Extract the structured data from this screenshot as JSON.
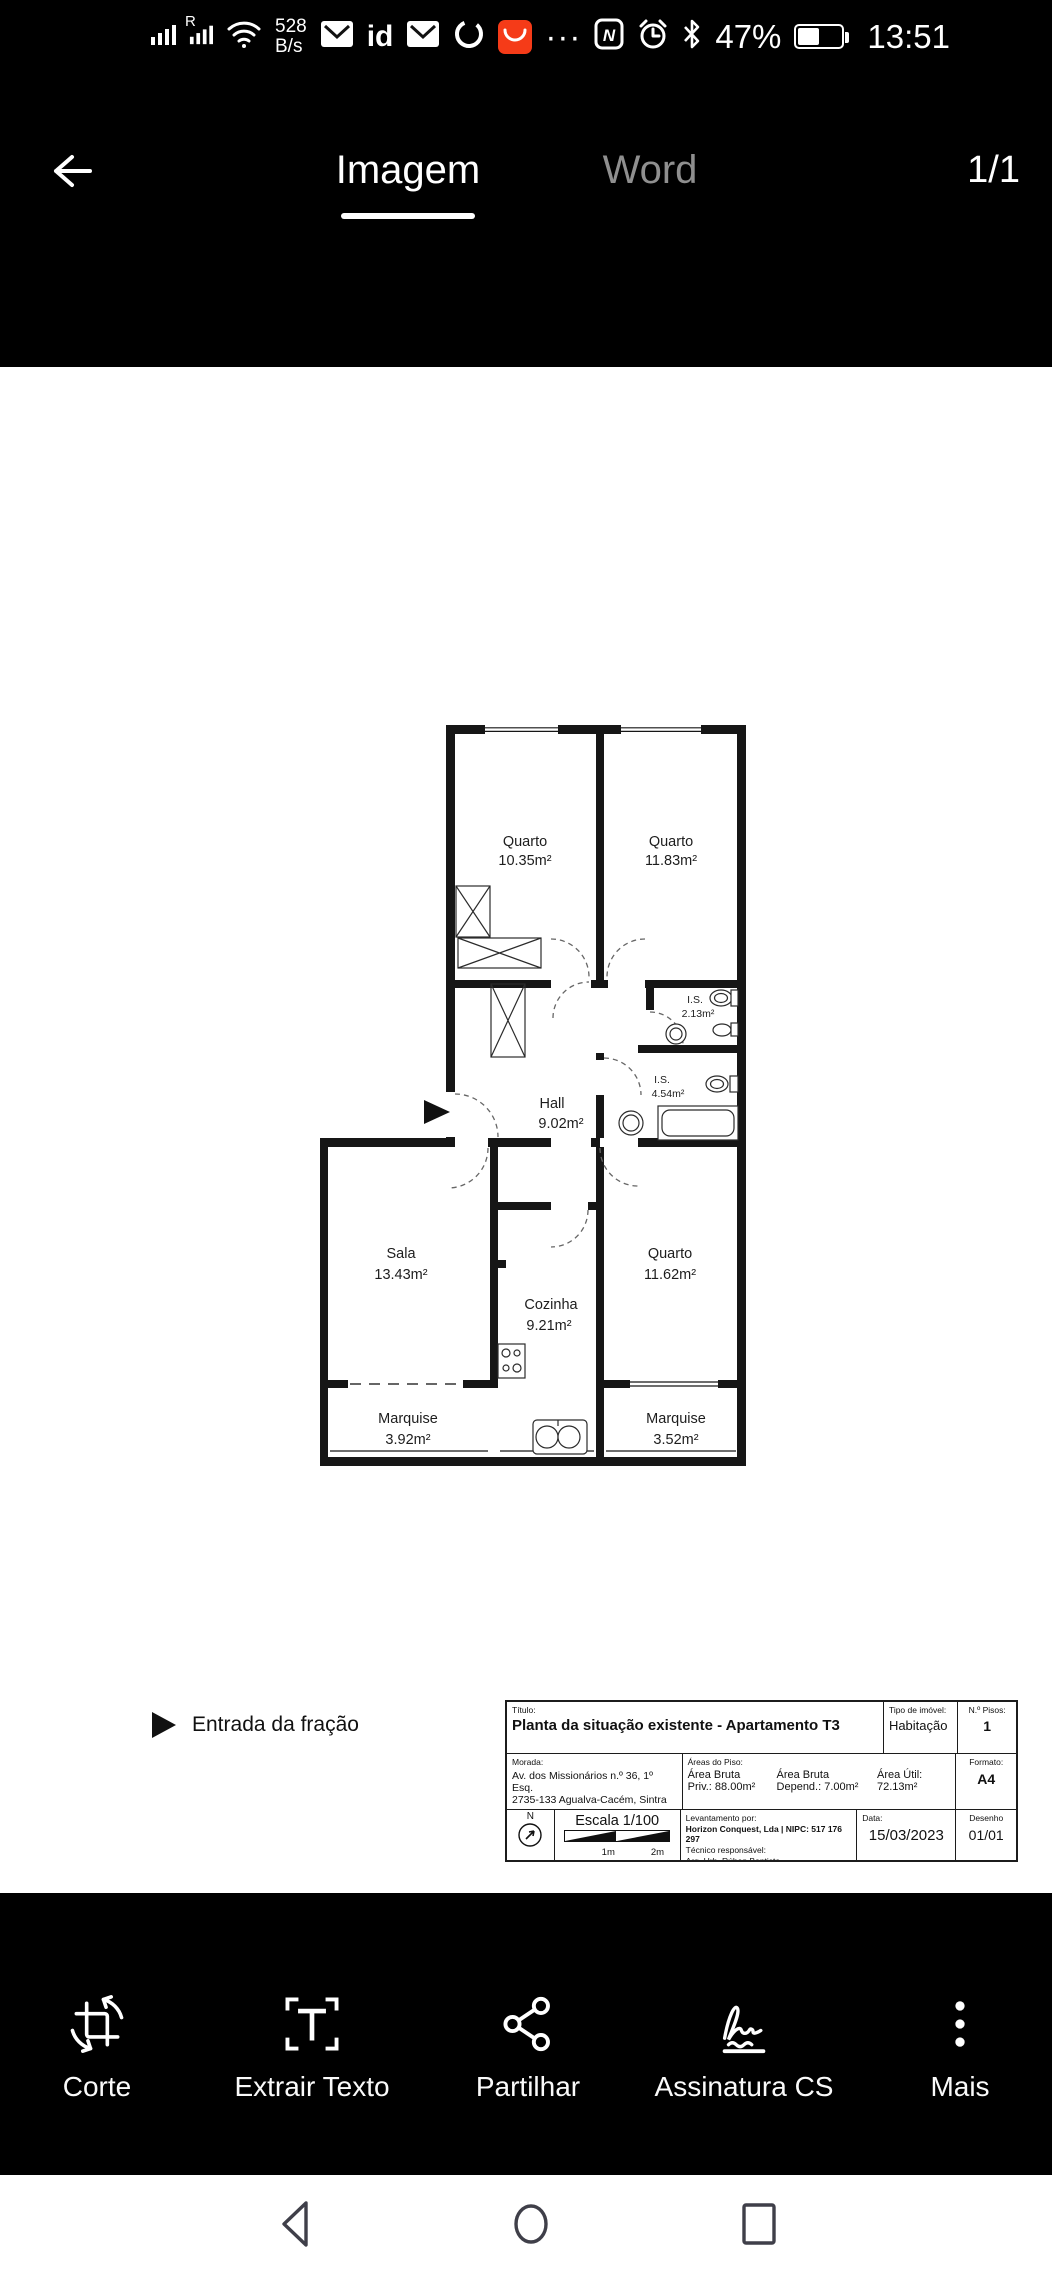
{
  "status_bar": {
    "roaming": "R",
    "net_speed_value": "528",
    "net_speed_unit": "B/s",
    "app_id_label": "id",
    "overflow_dots": "···",
    "nfc_letter": "N",
    "battery_percent": "47%",
    "time": "13:51",
    "icons": [
      "signal-bars-icon",
      "signal-bars-roaming-icon",
      "wifi-icon",
      "envelope-icon",
      "id-app-icon",
      "envelope-icon",
      "loop-ring-icon",
      "shopping-app-badge-icon",
      "overflow-dots-icon",
      "nfc-icon",
      "alarm-clock-icon",
      "bluetooth-icon",
      "battery-icon"
    ]
  },
  "header": {
    "tabs": [
      {
        "label": "Imagem",
        "active": true
      },
      {
        "label": "Word",
        "active": false
      }
    ],
    "page_indicator": "1/1"
  },
  "document": {
    "floor_plan": {
      "rooms": [
        {
          "name": "Quarto",
          "area": "10.35m²"
        },
        {
          "name": "Quarto",
          "area": "11.83m²"
        },
        {
          "name": "I.S.",
          "area": "2.13m²"
        },
        {
          "name": "I.S.",
          "area": "4.54m²"
        },
        {
          "name": "Hall",
          "area": "9.02m²"
        },
        {
          "name": "Sala",
          "area": "13.43m²"
        },
        {
          "name": "Cozinha",
          "area": "9.21m²"
        },
        {
          "name": "Quarto",
          "area": "11.62m²"
        },
        {
          "name": "Marquise",
          "area": "3.92m²"
        },
        {
          "name": "Marquise",
          "area": "3.52m²"
        }
      ],
      "entrance_legend": "Entrada da fração"
    },
    "title_block": {
      "titulo_label": "Título:",
      "titulo": "Planta da situação existente - Apartamento T3",
      "tipo_imovel_label": "Tipo de imóvel:",
      "tipo_imovel": "Habitação",
      "num_pisos_label": "N.º Pisos:",
      "num_pisos": "1",
      "morada_label": "Morada:",
      "morada_linha1": "Av. dos Missionários n.º 36, 1º Esq.",
      "morada_linha2": "2735-133 Agualva-Cacém, Sintra",
      "areas_label": "Áreas do Piso:",
      "area_bruta_priv_l1": "Área Bruta",
      "area_bruta_priv_l2": "Priv.: 88.00m²",
      "area_bruta_dep_l1": "Área Bruta",
      "area_bruta_dep_l2": "Depend.: 7.00m²",
      "area_util_l1": "Área Útil:",
      "area_util_l2": "72.13m²",
      "formato_label": "Formato:",
      "formato": "A4",
      "north_label": "N",
      "escala": "Escala 1/100",
      "escala_1m": "1m",
      "escala_2m": "2m",
      "levantamento_label": "Levantamento por:",
      "levantamento": "Horizon Conquest, Lda | NIPC: 517 176 297",
      "tecnico_label": "Técnico responsável:",
      "tecnico": "Arq. Urb. Rúben Baptista",
      "data_label": "Data:",
      "data": "15/03/2023",
      "desenho_label": "Desenho",
      "desenho": "01/01"
    }
  },
  "toolbar": {
    "items": [
      {
        "label": "Corte",
        "icon": "crop-rotate-icon"
      },
      {
        "label": "Extrair Texto",
        "icon": "extract-text-icon"
      },
      {
        "label": "Partilhar",
        "icon": "share-icon"
      },
      {
        "label": "Assinatura CS",
        "icon": "signature-icon"
      },
      {
        "label": "Mais",
        "icon": "more-vertical-icon"
      }
    ]
  },
  "nav_bar": {
    "icons": [
      "back-triangle-icon",
      "home-circle-icon",
      "recents-square-icon"
    ]
  },
  "colors": {
    "accent_orange": "#f53b18",
    "nav_icon": "#3f3f49"
  }
}
